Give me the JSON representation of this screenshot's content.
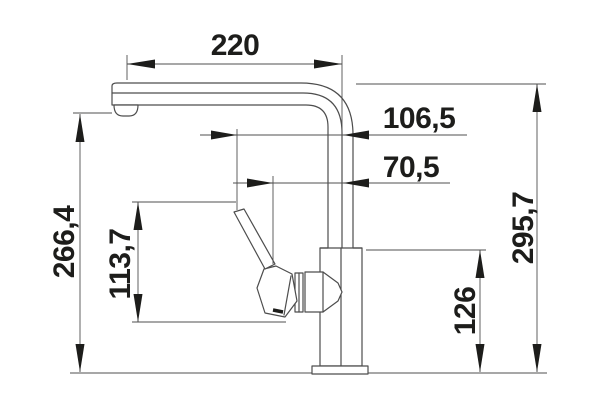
{
  "diagram": {
    "description": "Technical side-view dimension drawing of a kitchen mixer faucet",
    "unit_system": "millimeters",
    "dimensions": [
      {
        "id": "spout-reach",
        "value": "220",
        "orientation": "horizontal"
      },
      {
        "id": "lever-tip-offset",
        "value": "106,5",
        "orientation": "horizontal"
      },
      {
        "id": "lever-offset",
        "value": "70,5",
        "orientation": "horizontal"
      },
      {
        "id": "outlet-height",
        "value": "266,4",
        "orientation": "vertical"
      },
      {
        "id": "lever-height",
        "value": "113,7",
        "orientation": "vertical"
      },
      {
        "id": "body-height",
        "value": "126",
        "orientation": "vertical"
      },
      {
        "id": "overall-height",
        "value": "295,7",
        "orientation": "vertical"
      }
    ],
    "colors": {
      "background": "#ffffff",
      "outline": "#4d4d4d",
      "dimension_line": "#4f4f4f",
      "text": "#1d1d1b"
    }
  }
}
